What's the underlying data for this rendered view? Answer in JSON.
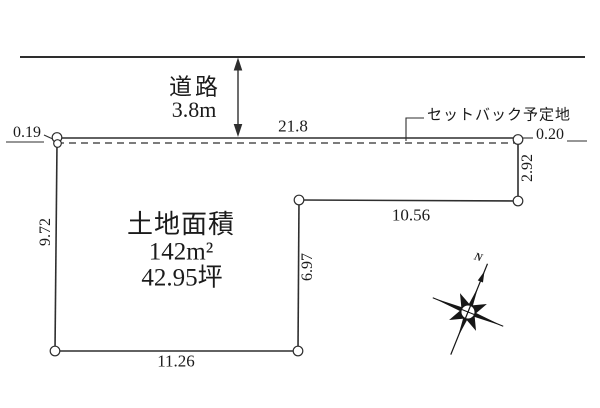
{
  "diagram": {
    "road": {
      "name": "道路",
      "width": "3.8m"
    },
    "setback": {
      "label": "セットバック予定地",
      "left_gap": "0.19",
      "right_gap": "0.20"
    },
    "parcel": {
      "area_title": "土地面積",
      "area_sqm": "142m²",
      "area_tsubo": "42.95坪",
      "dimensions": {
        "front": "21.8",
        "right": "2.92",
        "step_h": "10.56",
        "step_v": "6.97",
        "bottom": "11.26",
        "left": "9.72"
      }
    },
    "compass": {
      "north": "N"
    },
    "colors": {
      "line": "#2e2e2e",
      "text": "#1b1b1b",
      "background": "#ffffff"
    }
  }
}
